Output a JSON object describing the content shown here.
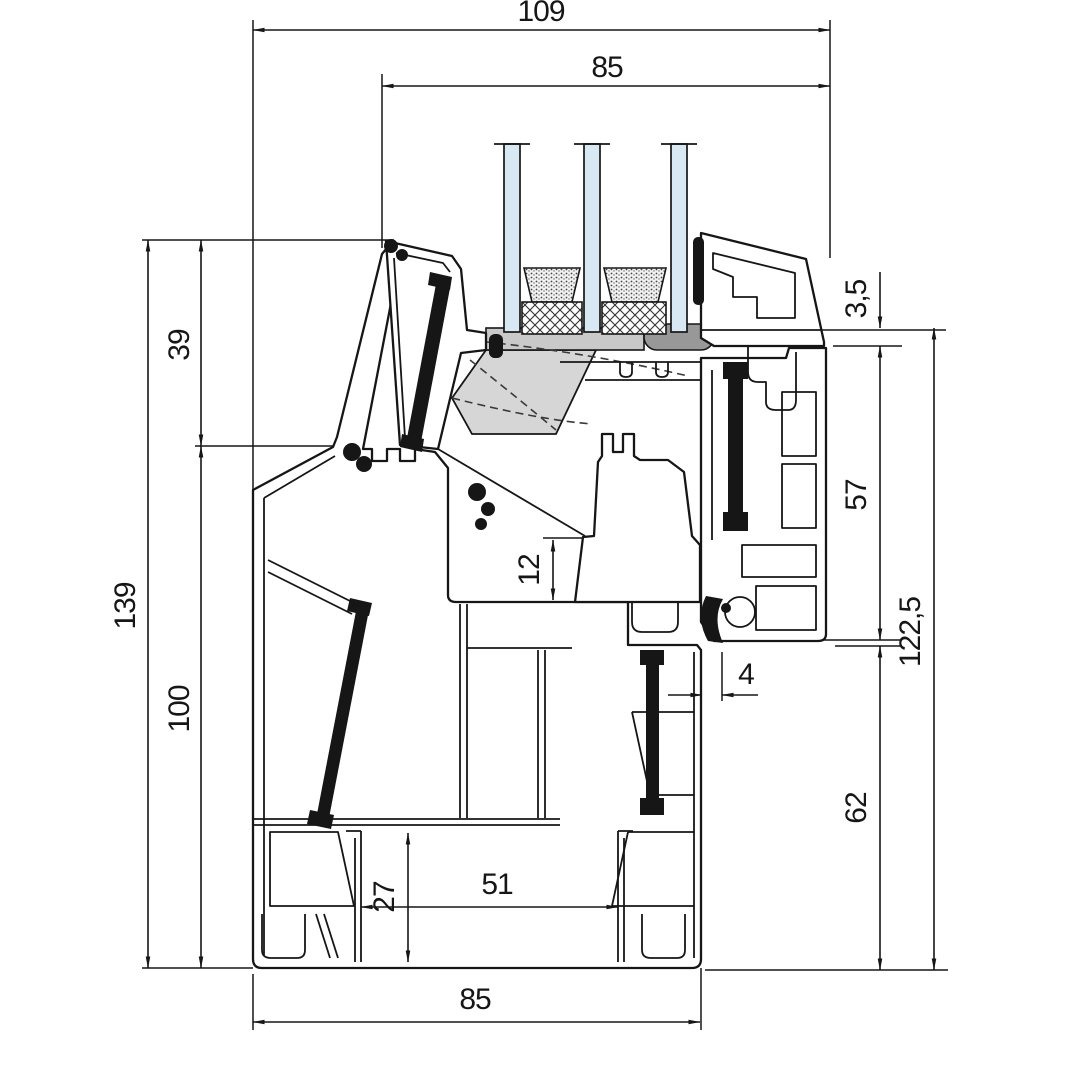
{
  "dims": {
    "top_total": "109",
    "top_sash": "85",
    "left_rebate": "39",
    "left_total": "139",
    "left_frame": "100",
    "right_bar": "3,5",
    "right_upper": "57",
    "right_total": "122,5",
    "right_lower": "62",
    "middle_gap": "12",
    "middle_offset": "4",
    "bottom_chamber_height": "27",
    "bottom_chamber_width": "51",
    "bottom_total": "85"
  },
  "colors": {
    "line": "#161616",
    "glass": "#d8e9f3",
    "gray_light": "#c9c9c9",
    "gray_dark": "#989898",
    "gray_wedge": "#d6d6d6",
    "background": "#ffffff"
  }
}
